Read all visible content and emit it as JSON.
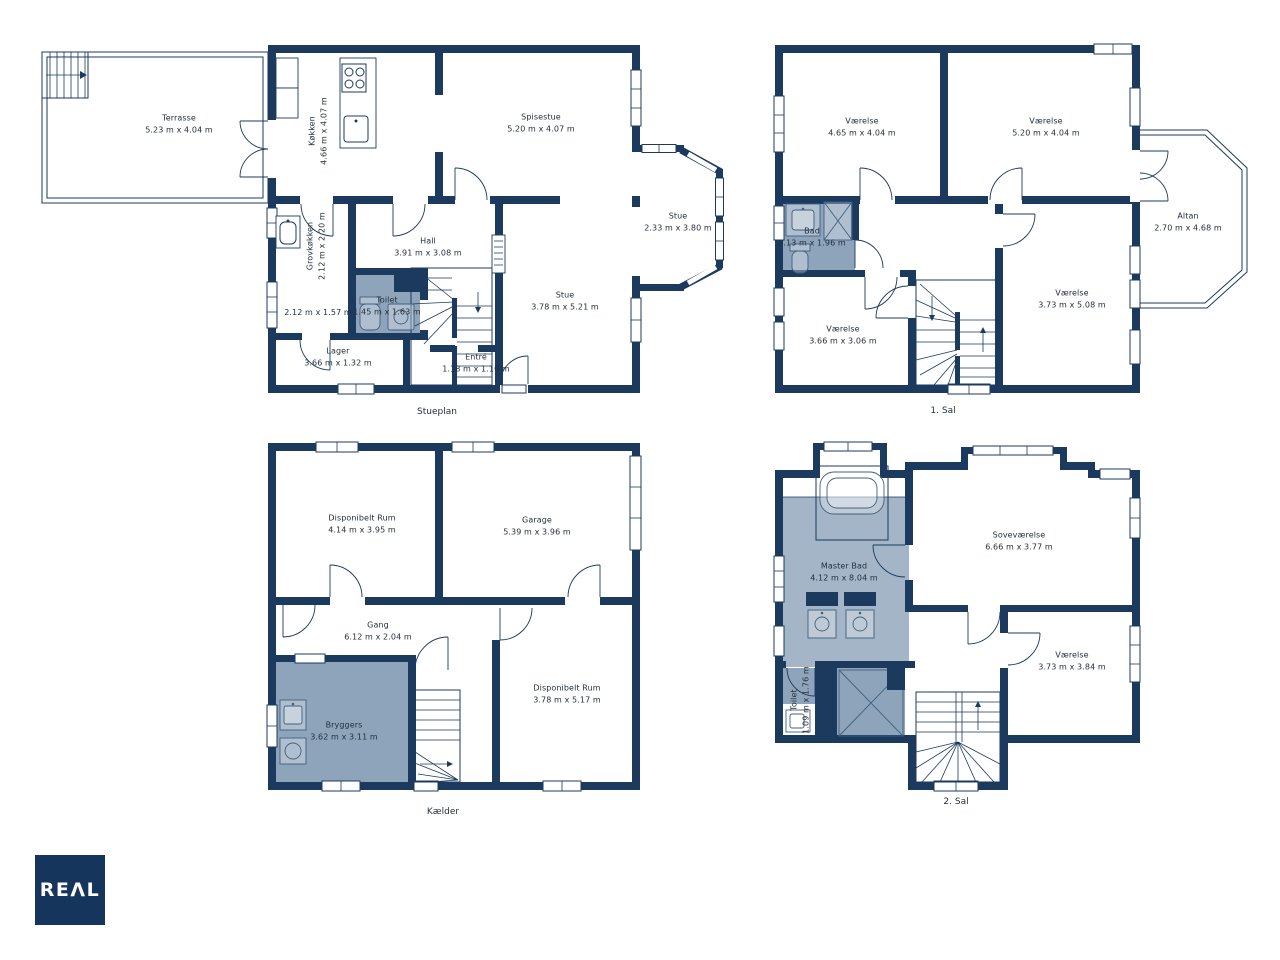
{
  "logo": {
    "text": "REΛL"
  },
  "colors": {
    "wall": "#1b3a5e",
    "wet_room_shade": "#8da4ba",
    "master_bath_shade": "#a3b5c6",
    "logo_background": "#16355d",
    "text": "#24303e"
  },
  "floors": [
    {
      "id": "stueplan",
      "label": "Stueplan",
      "rooms": [
        {
          "name": "Terrasse",
          "dims": "5.23 m x 4.04 m"
        },
        {
          "name": "Køkken",
          "dims": "4.66 m x 4.07 m"
        },
        {
          "name": "Spisestue",
          "dims": "5.20 m x 4.07 m"
        },
        {
          "name": "Grovkøkken",
          "dims": "2.12 m x 2.20 m"
        },
        {
          "name": "Hall",
          "dims": "3.91 m x 3.08 m"
        },
        {
          "name": "Toilet",
          "dims": "1.45 m x 1.63 m"
        },
        {
          "name": "",
          "dims": "2.12 m x 1.57 m"
        },
        {
          "name": "Stue",
          "dims": "3.78 m x 5.21 m"
        },
        {
          "name": "Stue",
          "dims": "2.33 m x 3.80 m"
        },
        {
          "name": "Lager",
          "dims": "3.66 m x 1.32 m"
        },
        {
          "name": "Entré",
          "dims": "1.18 m x 1.10 m"
        }
      ]
    },
    {
      "id": "first-floor",
      "label": "1. Sal",
      "rooms": [
        {
          "name": "Værelse",
          "dims": "4.65 m x 4.04 m"
        },
        {
          "name": "Værelse",
          "dims": "5.20 m x 4.04 m"
        },
        {
          "name": "Bad",
          "dims": "2.13 m x 1.96 m"
        },
        {
          "name": "Værelse",
          "dims": "3.66 m x 3.06 m"
        },
        {
          "name": "Værelse",
          "dims": "3.73 m x 5.08 m"
        },
        {
          "name": "Altan",
          "dims": "2.70 m x 4.68 m"
        }
      ]
    },
    {
      "id": "kaelder",
      "label": "Kælder",
      "rooms": [
        {
          "name": "Disponibelt Rum",
          "dims": "4.14 m x 3.95 m"
        },
        {
          "name": "Garage",
          "dims": "5.39 m x 3.96 m"
        },
        {
          "name": "Gang",
          "dims": "6.12 m x 2.04 m"
        },
        {
          "name": "Bryggers",
          "dims": "3.62 m x 3.11 m"
        },
        {
          "name": "Disponibelt Rum",
          "dims": "3.78 m x 5.17 m"
        }
      ]
    },
    {
      "id": "second-floor",
      "label": "2. Sal",
      "rooms": [
        {
          "name": "Master Bad",
          "dims": "4.12 m x 8.04 m"
        },
        {
          "name": "Soveværelse",
          "dims": "6.66 m x 3.77 m"
        },
        {
          "name": "Værelse",
          "dims": "3.73 m x 3.84 m"
        },
        {
          "name": "Toilet",
          "dims": "1.09 m x 1.76 m"
        }
      ]
    }
  ]
}
